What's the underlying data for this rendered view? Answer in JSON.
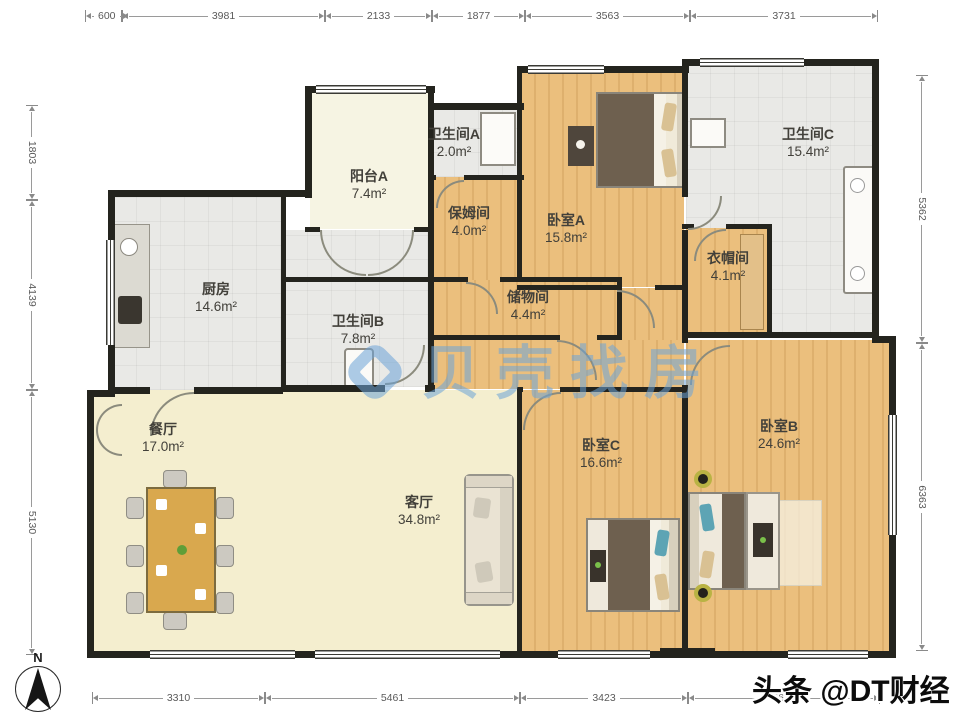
{
  "watermark": {
    "brand": "贝壳找房",
    "credit": "头条 @DT财经"
  },
  "compass": {
    "label": "N"
  },
  "rooms": [
    {
      "id": "balcony-a",
      "name": "阳台A",
      "area": "7.4m²"
    },
    {
      "id": "bath-a",
      "name": "卫生间A",
      "area": "2.0m²"
    },
    {
      "id": "nanny-room",
      "name": "保姆间",
      "area": "4.0m²"
    },
    {
      "id": "bedroom-a",
      "name": "卧室A",
      "area": "15.8m²"
    },
    {
      "id": "bath-c",
      "name": "卫生间C",
      "area": "15.4m²"
    },
    {
      "id": "cloakroom",
      "name": "衣帽间",
      "area": "4.1m²"
    },
    {
      "id": "kitchen",
      "name": "厨房",
      "area": "14.6m²"
    },
    {
      "id": "bath-b",
      "name": "卫生间B",
      "area": "7.8m²"
    },
    {
      "id": "storage",
      "name": "储物间",
      "area": "4.4m²"
    },
    {
      "id": "dining",
      "name": "餐厅",
      "area": "17.0m²"
    },
    {
      "id": "living",
      "name": "客厅",
      "area": "34.8m²"
    },
    {
      "id": "bedroom-c",
      "name": "卧室C",
      "area": "16.6m²"
    },
    {
      "id": "bedroom-b",
      "name": "卧室B",
      "area": "24.6m²"
    }
  ],
  "dimensions": {
    "top": [
      "600",
      "3981",
      "2133",
      "1877",
      "3563",
      "3731"
    ],
    "left": [
      "1803",
      "4139",
      "5130"
    ],
    "right": [
      "5362",
      "6363"
    ],
    "bottom": [
      "3310",
      "5461",
      "3423",
      "3671"
    ]
  }
}
